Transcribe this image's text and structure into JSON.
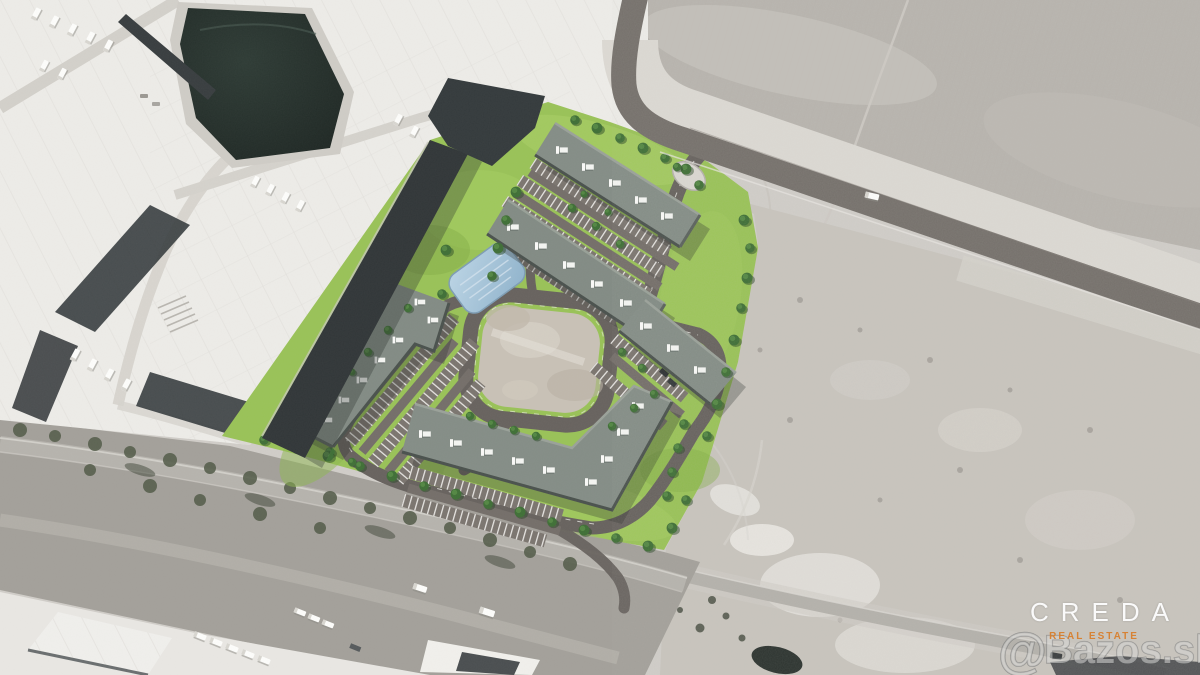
{
  "meta": {
    "kind": "aerial-photograph-with-development-render",
    "width_px": 1200,
    "height_px": 675
  },
  "branding": {
    "logo": "CREDA",
    "tagline": "REAL ESTATE",
    "logo_color": "#fafafa",
    "tagline_color": "#d87f2d"
  },
  "watermark": {
    "symbol": "@",
    "text": "Bazos.sk",
    "color": "rgba(214,214,211,0.55)"
  },
  "scene": {
    "labels": {
      "industrial_complex": "existing warehouse complex with white roofs",
      "dark_retention_pond": "dark retention basin",
      "development_site": "rendered development site with green landscaping",
      "stormwater_pond": "blue stormwater pond",
      "central_gravel_pad": "central gravel reserve area",
      "access_road": "new asphalt access road",
      "field": "plowed farm field",
      "scrubland": "undeveloped scrubland parcel",
      "tree_corridor": "tree-lined road corridor",
      "logistics_yard": "logistics yard with parked trucks"
    },
    "colors": {
      "site_green": "#99c257",
      "building_roof": "#848d86",
      "internal_road": "#67625e",
      "main_road": "#75706b",
      "field": "#b8b4ae",
      "scrub": "#c8c4bd",
      "dark_pond": "#232b27",
      "blue_pond": "#a3c3db",
      "warehouse_white": "#edece8"
    }
  }
}
